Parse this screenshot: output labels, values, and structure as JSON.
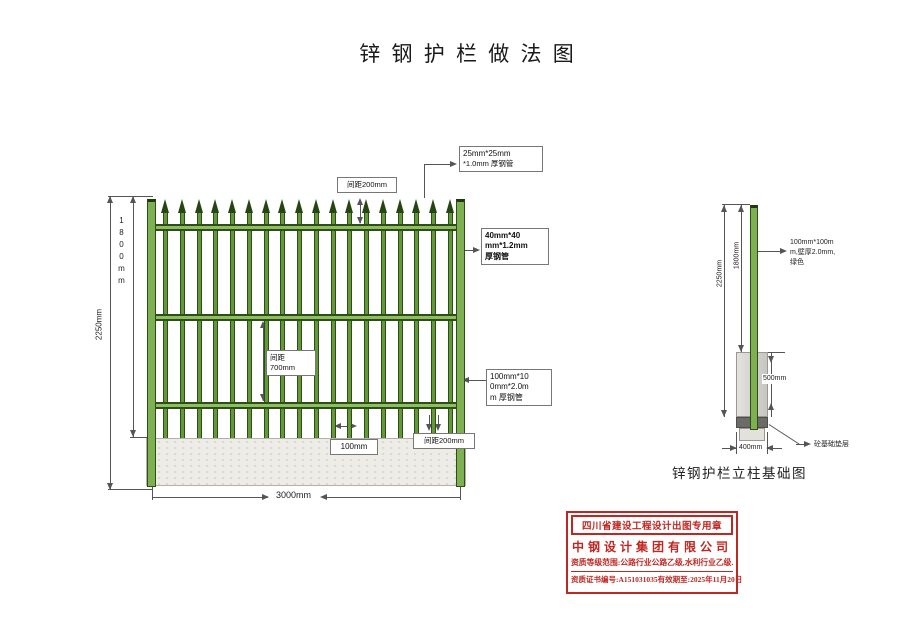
{
  "title": "锌 钢 护 栏 做 法 图",
  "colors": {
    "fence_green": "#7cb050",
    "fence_dark_green": "#2e4d1a",
    "stamp_red": "#bf2722",
    "concrete_gray": "#edece6"
  },
  "main_drawing": {
    "labels": {
      "picket_size_line1": "25mm*25mm",
      "picket_size_line2": "*1.0mm 厚钢管",
      "top_spacing": "间距200mm",
      "rail_size_line1": "40mm*40",
      "rail_size_line2": "mm*1.2mm",
      "rail_size_line3": "厚钢管",
      "mid_spacing_line1": "间距",
      "mid_spacing_line2": "700mm",
      "post_size_line1": "100mm*10",
      "post_size_line2": "0mm*2.0m",
      "post_size_line3": "m 厚钢管",
      "picket_width": "100mm",
      "bottom_spacing": "间距200mm"
    },
    "dimensions": {
      "height_total": "2250mm",
      "height_panel": "1800mm",
      "width_span": "3000mm"
    },
    "fence": {
      "picket_count": 18
    }
  },
  "detail_drawing": {
    "caption": "锌钢护栏立柱基础图",
    "labels": {
      "post_spec_line1": "100mm*100m",
      "post_spec_line2": "m,壁厚2.0mm,",
      "post_spec_line3": "绿色",
      "cushion": "砼基础垫层"
    },
    "dimensions": {
      "above_ground": "1800mm",
      "total_height": "2250mm",
      "embed_depth": "500mm",
      "base_width": "400mm"
    }
  },
  "stamp": {
    "header": "四川省建设工程设计出图专用章",
    "company": "中钢设计集团有限公司",
    "qualification": "资质等级范围:公路行业公路乙级,水利行业乙级.",
    "cert_no": "资质证书编号:A151031035",
    "validity": "有效期至:2025年11月20日"
  }
}
